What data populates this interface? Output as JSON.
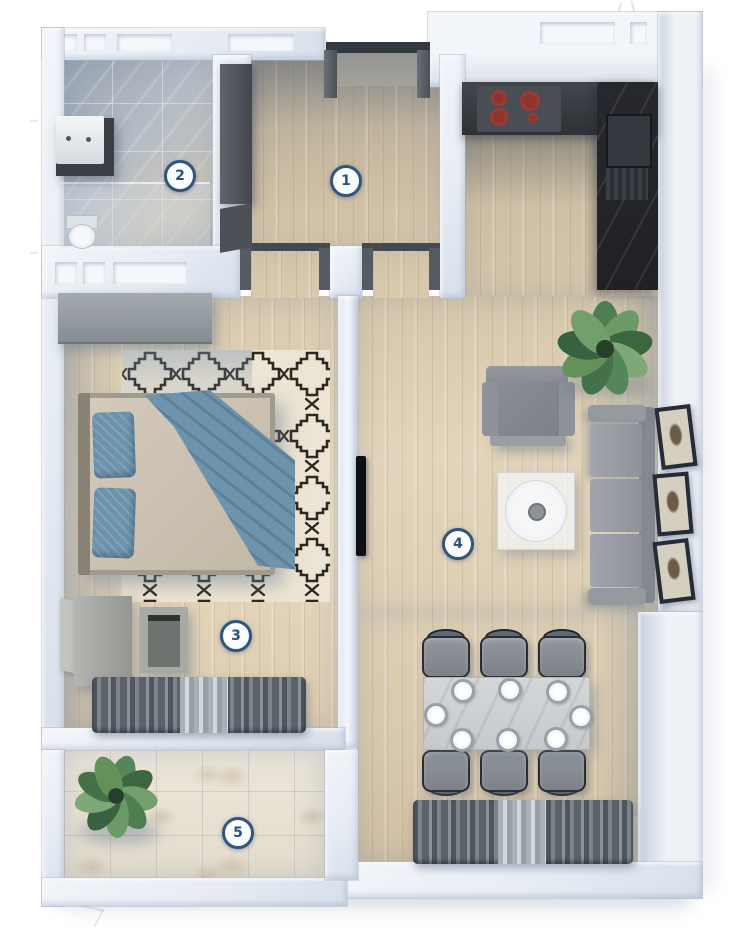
{
  "rooms": [
    {
      "number": "1",
      "name": "hallway"
    },
    {
      "number": "2",
      "name": "bathroom"
    },
    {
      "number": "3",
      "name": "bedroom"
    },
    {
      "number": "4",
      "name": "living-room-with-kitchen"
    },
    {
      "number": "5",
      "name": "balcony"
    }
  ],
  "badge_style": {
    "background": "#fbfdfe",
    "border": "#31567d",
    "text": "#29517c"
  },
  "palette": {
    "wall_face": "#eef1f6",
    "wall_side": "#c7d1df",
    "wood_floor": "#ddcdb2",
    "bathroom_tile": "#adb6c0",
    "balcony_tile": "#e9e3d7",
    "kitchen_counter": "#33363b",
    "stove_burner": "#b0423a",
    "sofa_gray": "#94989e",
    "bed_blanket": "#6e93ad",
    "rug_base": "#ede5d3",
    "rug_pattern": "#2e2822",
    "curtain_gray": "#63686e",
    "plant_green": "#4e7c50"
  }
}
